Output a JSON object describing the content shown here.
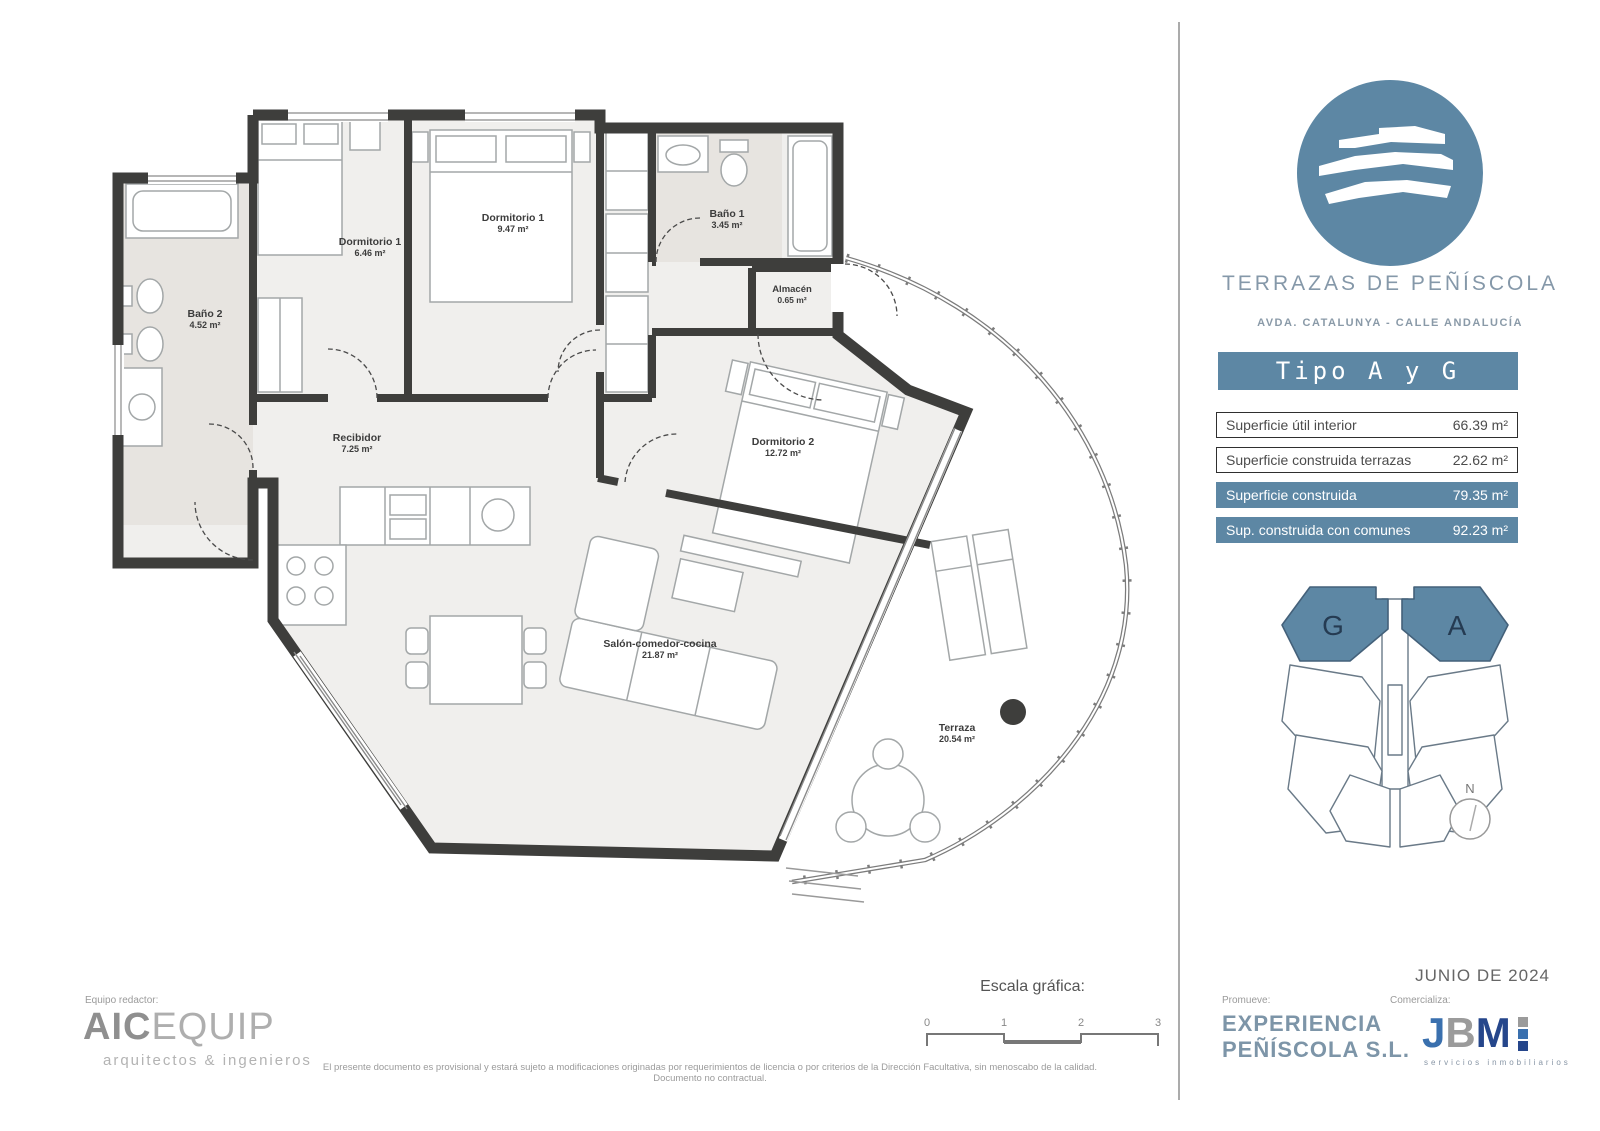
{
  "header": {
    "project_title": "TERRAZAS DE PEÑÍSCOLA",
    "project_address": "AVDA. CATALUNYA - CALLE ANDALUCÍA",
    "unit_type_banner": "Tipo A y G"
  },
  "areas_table": {
    "rows": [
      {
        "label": "Superficie útil interior",
        "value": "66.39 m²",
        "highlight": false
      },
      {
        "label": "Superficie construida terrazas",
        "value": "22.62 m²",
        "highlight": false
      },
      {
        "label": "Superficie construida",
        "value": "79.35 m²",
        "highlight": true
      },
      {
        "label": "Sup. construida con comunes",
        "value": "92.23 m²",
        "highlight": true
      }
    ]
  },
  "floor_plan": {
    "rooms": [
      {
        "name": "Dormitorio 1",
        "area": "6.46 m²"
      },
      {
        "name": "Dormitorio 1",
        "area": "9.47 m²"
      },
      {
        "name": "Baño 1",
        "area": "3.45 m²"
      },
      {
        "name": "Baño 2",
        "area": "4.52 m²"
      },
      {
        "name": "Almacén",
        "area": "0.65 m²"
      },
      {
        "name": "Dormitorio 2",
        "area": "12.72 m²"
      },
      {
        "name": "Recibidor",
        "area": "7.25 m²"
      },
      {
        "name": "Salón-comedor-cocina",
        "area": "21.87 m²"
      },
      {
        "name": "Terraza",
        "area": "20.54 m²"
      }
    ]
  },
  "key_plan": {
    "unit_left_label": "G",
    "unit_right_label": "A",
    "north_label": "N"
  },
  "scale_bar": {
    "label": "Escala gráfica:",
    "t0": "0",
    "t1": "1",
    "t2": "2",
    "t3": "3"
  },
  "footer": {
    "team_label": "Equipo redactor:",
    "team_name_strong": "AIC",
    "team_name_light": "EQUIP",
    "team_tagline": "arquitectos & ingenieros",
    "disclaimer": "El presente documento es provisional y estará sujeto a modificaciones originadas por requerimientos de licencia o por criterios de la Dirección Facultativa, sin menoscabo de la calidad. Documento no contractual.",
    "developer_label": "Promueve:",
    "developer_line1": "EXPERIENCIA",
    "developer_line2": "PEÑÍSCOLA S.L.",
    "agency_label": "Comercializa:",
    "agency_letter_j": "J",
    "agency_letter_b": "B",
    "agency_letter_m": "M",
    "agency_tagline": "servicios inmobiliarios",
    "issue_date": "JUNIO DE 2024"
  },
  "colors": {
    "accent_blue": "#5d87a4",
    "wall_dark": "#3e3e3c",
    "room_fill": "#f0efed",
    "bath_fill": "#e7e4e0",
    "jbm_blue": "#3a70ae",
    "jbm_navy": "#25468b"
  }
}
